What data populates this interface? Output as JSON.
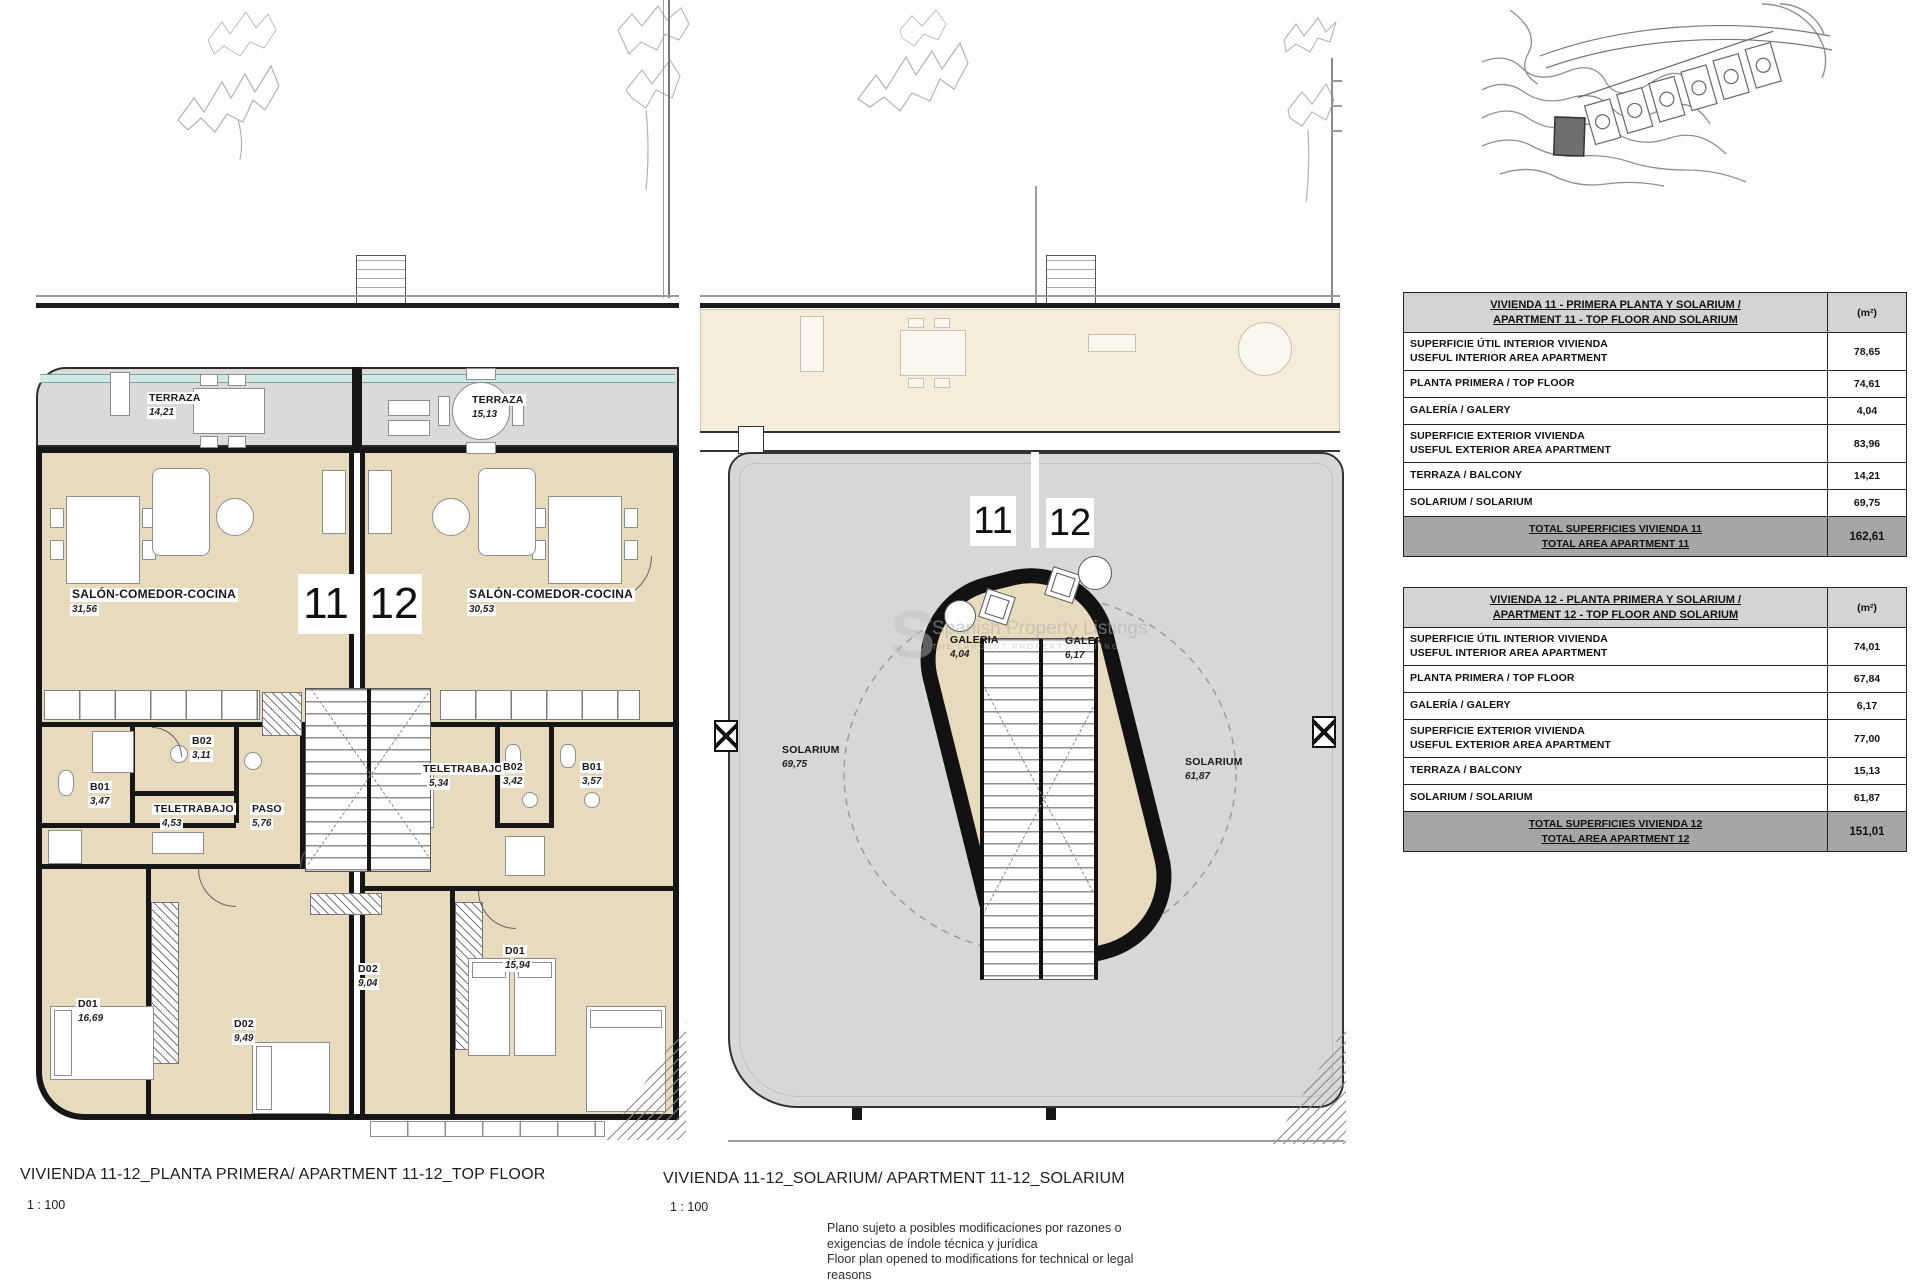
{
  "colors": {
    "room_fill": "#e8dabd",
    "faded_room_fill": "#f5ecd9",
    "terrace_fill": "#dadada",
    "solarium_fill": "#d7d7d7",
    "rail_accent": "#cfe9e9",
    "wall": "#161616",
    "table_header_bg": "#d4d4d4",
    "table_total_bg": "#a6a6a6"
  },
  "plan1": {
    "big11": "11",
    "big12": "12",
    "terraza11": {
      "n": "TERRAZA",
      "a": "14,21"
    },
    "terraza12": {
      "n": "TERRAZA",
      "a": "15,13"
    },
    "salon11": {
      "n": "SALÓN-COMEDOR-COCINA",
      "a": "31,56"
    },
    "salon12": {
      "n": "SALÓN-COMEDOR-COCINA",
      "a": "30,53"
    },
    "b02_11": {
      "n": "B02",
      "a": "3,11"
    },
    "b01_11": {
      "n": "B01",
      "a": "3,47"
    },
    "tele11": {
      "n": "TELETRABAJO",
      "a": "4,53"
    },
    "paso11": {
      "n": "PASO",
      "a": "5,76"
    },
    "tele12": {
      "n": "TELETRABAJO",
      "a": "5,34"
    },
    "b02_12": {
      "n": "B02",
      "a": "3,42"
    },
    "b01_12": {
      "n": "B01",
      "a": "3,57"
    },
    "d01_11": {
      "n": "D01",
      "a": "16,69"
    },
    "d02_11": {
      "n": "D02",
      "a": "9,49"
    },
    "d02_12": {
      "n": "D02",
      "a": "9,04"
    },
    "d01_12": {
      "n": "D01",
      "a": "15,94"
    }
  },
  "plan2": {
    "big11": "11",
    "big12": "12",
    "galeria11": {
      "n": "GALERIA",
      "a": "4,04"
    },
    "galeria12": {
      "n": "GALERIA",
      "a": "6,17"
    },
    "solarium11": {
      "n": "SOLARIUM",
      "a": "69,75"
    },
    "solarium12": {
      "n": "SOLARIUM",
      "a": "61,87"
    }
  },
  "tables": [
    {
      "title1": "VIVIENDA 11 - PRIMERA PLANTA Y SOLARIUM /",
      "title2": "APARTMENT 11 - TOP FLOOR AND SOLARIUM",
      "unit": "(m²)",
      "rows": [
        {
          "l1": "SUPERFICIE ÚTIL INTERIOR VIVIENDA",
          "l2": "USEFUL INTERIOR AREA APARTMENT",
          "v": "78,65"
        },
        {
          "l1": "PLANTA PRIMERA / TOP FLOOR",
          "v": "74,61"
        },
        {
          "l1": "GALERÍA / GALERY",
          "v": "4,04"
        },
        {
          "l1": "SUPERFICIE EXTERIOR VIVIENDA",
          "l2": "USEFUL EXTERIOR AREA APARTMENT",
          "v": "83,96"
        },
        {
          "l1": "TERRAZA / BALCONY",
          "v": "14,21"
        },
        {
          "l1": "SOLARIUM / SOLARIUM",
          "v": "69,75"
        }
      ],
      "total1": "TOTAL SUPERFICIES VIVIENDA 11",
      "total2": "TOTAL AREA APARTMENT 11",
      "totalv": "162,61"
    },
    {
      "title1": "VIVIENDA 12 - PLANTA PRIMERA Y SOLARIUM /",
      "title2": "APARTMENT 12 - TOP FLOOR AND SOLARIUM",
      "unit": "(m²)",
      "rows": [
        {
          "l1": "SUPERFICIE ÚTIL INTERIOR VIVIENDA",
          "l2": "USEFUL INTERIOR AREA APARTMENT",
          "v": "74,01"
        },
        {
          "l1": "PLANTA PRIMERA / TOP FLOOR",
          "v": "67,84"
        },
        {
          "l1": "GALERÍA / GALERY",
          "v": "6,17"
        },
        {
          "l1": "SUPERFICIE EXTERIOR VIVIENDA",
          "l2": "USEFUL EXTERIOR AREA APARTMENT",
          "v": "77,00"
        },
        {
          "l1": "TERRAZA / BALCONY",
          "v": "15,13"
        },
        {
          "l1": "SOLARIUM / SOLARIUM",
          "v": "61,87"
        }
      ],
      "total1": "TOTAL SUPERFICIES VIVIENDA 12",
      "total2": "TOTAL AREA APARTMENT 12",
      "totalv": "151,01"
    }
  ],
  "captions": {
    "plan1_title": "VIVIENDA 11-12_PLANTA PRIMERA/ APARTMENT 11-12_TOP FLOOR",
    "plan1_scale": "1 : 100",
    "plan2_title": "VIVIENDA 11-12_SOLARIUM/ APARTMENT 11-12_SOLARIUM",
    "plan2_scale": "1 : 100",
    "disclaimer1": "Plano sujeto a posibles modificaciones por razones o",
    "disclaimer2": "exigencias de índole técnica y jurídica",
    "disclaimer3": "Floor plan opened to modifications for technical or legal",
    "disclaimer4": "reasons"
  },
  "watermark": {
    "initial": "S",
    "line1": "Spanish Property Listings",
    "line2": "THE LARGEST PROPERTY LISTING"
  }
}
